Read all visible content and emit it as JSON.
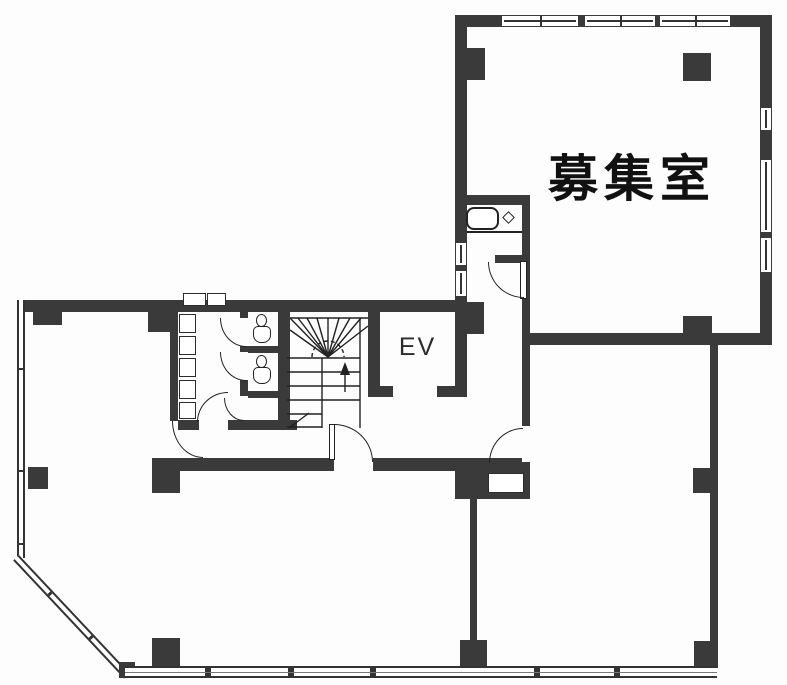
{
  "labels": {
    "main_room": "募集室",
    "elevator": "EV"
  },
  "colors": {
    "wall": "#3a3a3a",
    "line": "#222222",
    "background": "#fdfdfd"
  },
  "fixtures": {
    "toilet_count": 2,
    "sink_count": 1,
    "staircase_count": 1,
    "elevator_count": 1
  }
}
